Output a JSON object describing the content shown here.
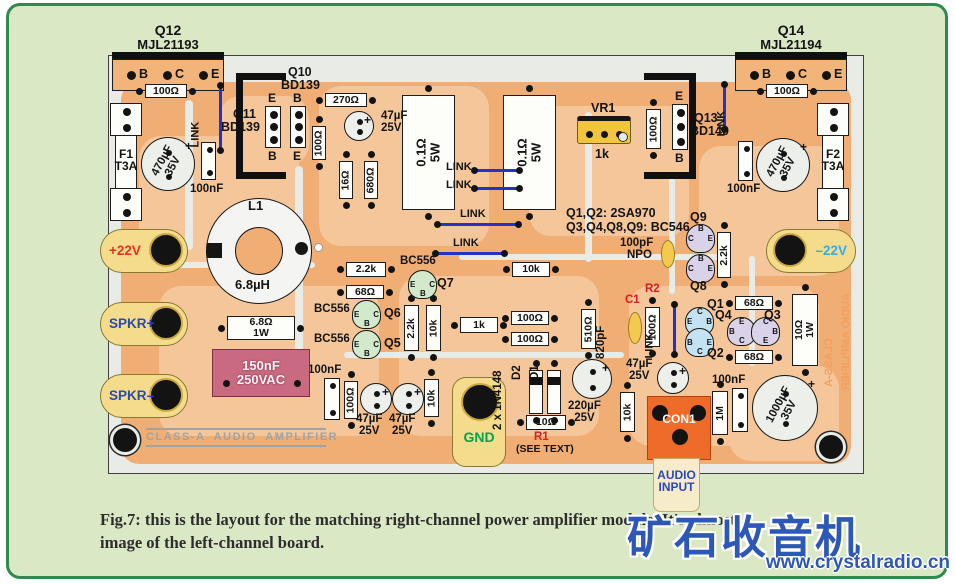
{
  "caption": {
    "line1": "Fig.7: this is the layout for the matching right-channel power amplifier module. It's almost",
    "line2": "image of the left-channel board."
  },
  "watermark": {
    "brand": "矿石收音机",
    "url": "www.crystalradio.cn"
  },
  "colors": {
    "panel_bg": "#dbe8c6",
    "panel_border": "#2e8a4d",
    "board_bg": "#e9ebe7",
    "copper": "#f0ad74",
    "copper_light": "#f5c69a",
    "terminal_yellow": "#f4dc8c",
    "connector_orange": "#ef6b2a",
    "film_pink": "#c96a80",
    "link_blue": "#2233c8",
    "red_label": "#d42020",
    "blue_label": "#2b48b8",
    "gnd_green": "#00a550",
    "neg22_blue": "#35aaee",
    "silk_gray": "#9fa4a2",
    "mirror_orange": "#f0a060"
  },
  "components": [
    {
      "id": "q12-header",
      "k": "header",
      "x": 112,
      "y": 52,
      "w": 112,
      "pins": [
        "B",
        "C",
        "E"
      ]
    },
    {
      "id": "q14-header",
      "k": "header",
      "x": 735,
      "y": 52,
      "w": 112,
      "pins": [
        "B",
        "C",
        "E"
      ]
    },
    {
      "id": "label-q12",
      "k": "text",
      "x": 123,
      "y": 23,
      "w": 90,
      "t": "Q12",
      "size": 14,
      "align": "center"
    },
    {
      "id": "label-q12-part",
      "k": "text",
      "x": 123,
      "y": 38,
      "w": 90,
      "t": "MJL21193",
      "size": 13,
      "align": "center"
    },
    {
      "id": "label-q14",
      "k": "text",
      "x": 746,
      "y": 23,
      "w": 90,
      "t": "Q14",
      "size": 14,
      "align": "center"
    },
    {
      "id": "label-q14-part",
      "k": "text",
      "x": 746,
      "y": 38,
      "w": 90,
      "t": "MJL21194",
      "size": 13,
      "align": "center"
    },
    {
      "id": "res-100r-topleft",
      "k": "resh",
      "x": 145,
      "y": 84,
      "w": 42,
      "h": 14,
      "t": "100Ω"
    },
    {
      "id": "res-270r",
      "k": "resh",
      "x": 325,
      "y": 93,
      "w": 42,
      "h": 14,
      "t": "270Ω"
    },
    {
      "id": "res-100r-topright",
      "k": "resh",
      "x": 766,
      "y": 84,
      "w": 42,
      "h": 14,
      "t": "100Ω"
    },
    {
      "id": "res-2k2-mid",
      "k": "resh",
      "x": 346,
      "y": 262,
      "w": 40,
      "h": 15,
      "t": "2.2k"
    },
    {
      "id": "res-68r-mid",
      "k": "resh",
      "x": 346,
      "y": 285,
      "w": 38,
      "h": 14,
      "t": "68Ω"
    },
    {
      "id": "res-10k-mid",
      "k": "resh",
      "x": 512,
      "y": 262,
      "w": 38,
      "h": 15,
      "t": "10k"
    },
    {
      "id": "res-1k",
      "k": "resh",
      "x": 460,
      "y": 317,
      "w": 38,
      "h": 16,
      "t": "1k"
    },
    {
      "id": "res-100r-a",
      "k": "resh",
      "x": 511,
      "y": 311,
      "w": 38,
      "h": 14,
      "t": "100Ω"
    },
    {
      "id": "res-100r-b",
      "k": "resh",
      "x": 511,
      "y": 332,
      "w": 38,
      "h": 14,
      "t": "100Ω"
    },
    {
      "id": "res-68r-q1",
      "k": "resh",
      "x": 735,
      "y": 296,
      "w": 38,
      "h": 14,
      "t": "68Ω"
    },
    {
      "id": "res-68r-q2",
      "k": "resh",
      "x": 735,
      "y": 350,
      "w": 38,
      "h": 14,
      "t": "68Ω"
    },
    {
      "id": "res-6r8-1w",
      "k": "resh",
      "x": 227,
      "y": 316,
      "w": 68,
      "h": 24,
      "t": "6.8Ω",
      "t2": "1W"
    },
    {
      "id": "res-10r-r1",
      "k": "resh",
      "x": 526,
      "y": 415,
      "w": 40,
      "h": 15,
      "t": "10Ω"
    },
    {
      "id": "res-100r-v1",
      "k": "resv",
      "x": 312,
      "y": 126,
      "w": 14,
      "h": 34,
      "t": "100Ω"
    },
    {
      "id": "res-16r",
      "k": "resv",
      "x": 339,
      "y": 161,
      "w": 14,
      "h": 38,
      "t": "16Ω"
    },
    {
      "id": "res-680r",
      "k": "resv",
      "x": 364,
      "y": 161,
      "w": 14,
      "h": 38,
      "t": "680Ω"
    },
    {
      "id": "res-100r-v2",
      "k": "resv",
      "x": 646,
      "y": 109,
      "w": 15,
      "h": 40,
      "t": "100Ω"
    },
    {
      "id": "res-2k2-v",
      "k": "resv",
      "x": 404,
      "y": 305,
      "w": 15,
      "h": 46,
      "t": "2.2k"
    },
    {
      "id": "res-10k-v1",
      "k": "resv",
      "x": 426,
      "y": 305,
      "w": 15,
      "h": 46,
      "t": "10k"
    },
    {
      "id": "res-510r",
      "k": "resv",
      "x": 581,
      "y": 309,
      "w": 15,
      "h": 40,
      "t": "510Ω"
    },
    {
      "id": "res-100r-v3",
      "k": "resv",
      "x": 645,
      "y": 307,
      "w": 15,
      "h": 40,
      "t": "100Ω"
    },
    {
      "id": "res-2k2-v2",
      "k": "resv",
      "x": 717,
      "y": 232,
      "w": 14,
      "h": 46,
      "t": "2.2k"
    },
    {
      "id": "res-10k-v2",
      "k": "resv",
      "x": 424,
      "y": 379,
      "w": 15,
      "h": 38,
      "t": "10k"
    },
    {
      "id": "res-100r-v4",
      "k": "resv",
      "x": 344,
      "y": 381,
      "w": 14,
      "h": 38,
      "t": "100Ω"
    },
    {
      "id": "res-10k-v3",
      "k": "resv",
      "x": 620,
      "y": 392,
      "w": 15,
      "h": 40,
      "t": "10k"
    },
    {
      "id": "res-1m",
      "k": "resv",
      "x": 712,
      "y": 391,
      "w": 16,
      "h": 44,
      "t": "1M"
    },
    {
      "id": "res-10r-1w",
      "k": "resv",
      "x": 792,
      "y": 294,
      "w": 26,
      "h": 72,
      "t": "10Ω",
      "t2": "1W"
    },
    {
      "id": "res-0r1-5w-a",
      "k": "resv",
      "x": 402,
      "y": 95,
      "w": 53,
      "h": 115,
      "t": "0.1Ω",
      "t2": "5W",
      "big": 1
    },
    {
      "id": "res-0r1-5w-b",
      "k": "resv",
      "x": 503,
      "y": 95,
      "w": 53,
      "h": 115,
      "t": "0.1Ω",
      "t2": "5W",
      "big": 1
    },
    {
      "id": "cap-100nf-1",
      "k": "nf",
      "x": 201,
      "y": 142,
      "w": 15,
      "h": 38
    },
    {
      "id": "cap-100nf-2",
      "k": "nf",
      "x": 738,
      "y": 141,
      "w": 15,
      "h": 40
    },
    {
      "id": "cap-100nf-3",
      "k": "nf",
      "x": 324,
      "y": 378,
      "w": 16,
      "h": 42
    },
    {
      "id": "cap-100nf-4",
      "k": "nf",
      "x": 732,
      "y": 388,
      "w": 16,
      "h": 44
    },
    {
      "id": "label-100nf-1",
      "k": "text",
      "x": 190,
      "y": 184,
      "t": "100nF"
    },
    {
      "id": "label-100nf-2",
      "k": "text",
      "x": 727,
      "y": 184,
      "t": "100nF"
    },
    {
      "id": "label-100nf-3",
      "k": "text",
      "x": 308,
      "y": 365,
      "t": "100nF"
    },
    {
      "id": "label-100nf-4",
      "k": "text",
      "x": 712,
      "y": 375,
      "t": "100nF"
    },
    {
      "id": "cap-150nf",
      "k": "film",
      "x": 212,
      "y": 349,
      "w": 98,
      "h": 48,
      "t": "150nF",
      "t2": "250VAC"
    },
    {
      "id": "cap-100pf",
      "k": "oval",
      "x": 661,
      "y": 240,
      "w": 14,
      "h": 28
    },
    {
      "id": "cap-820pf",
      "k": "oval",
      "x": 628,
      "y": 312,
      "w": 14,
      "h": 32
    },
    {
      "id": "label-100pf",
      "k": "text",
      "x": 620,
      "y": 238,
      "t": "100pF"
    },
    {
      "id": "label-npo",
      "k": "text",
      "x": 627,
      "y": 250,
      "t": "NPO"
    },
    {
      "id": "label-c1",
      "k": "text",
      "x": 625,
      "y": 295,
      "t": "C1",
      "color": "#d42020"
    },
    {
      "id": "label-r2",
      "k": "text",
      "x": 645,
      "y": 284,
      "t": "R2",
      "color": "#d42020"
    },
    {
      "id": "label-820pf",
      "k": "text",
      "x": 608,
      "y": 347,
      "t": "820pF",
      "rot": -90
    },
    {
      "id": "cap-470uf-left",
      "k": "capbig",
      "cx": 168,
      "cy": 164,
      "r": 27,
      "t": "470µF",
      "t2": "35V"
    },
    {
      "id": "cap-470uf-right",
      "k": "capbig",
      "cx": 783,
      "cy": 165,
      "r": 27,
      "t": "470µF",
      "t2": "35V"
    },
    {
      "id": "cap-1000uf",
      "k": "capbig",
      "cx": 785,
      "cy": 408,
      "r": 33,
      "t": "1000µF",
      "t2": "35V"
    },
    {
      "id": "cap-47uf-top",
      "k": "cap",
      "cx": 359,
      "cy": 126,
      "r": 15
    },
    {
      "id": "label-47uf-top",
      "k": "text",
      "x": 381,
      "y": 111,
      "t": "47µF",
      "t2": "25V",
      "align": "left"
    },
    {
      "id": "cap-47uf-a",
      "k": "cap",
      "cx": 376,
      "cy": 399,
      "r": 16
    },
    {
      "id": "cap-47uf-b",
      "k": "cap",
      "cx": 408,
      "cy": 399,
      "r": 16
    },
    {
      "id": "label-47uf-a",
      "k": "text",
      "x": 356,
      "y": 414,
      "t": "47µF",
      "t2": "25V"
    },
    {
      "id": "label-47uf-b",
      "k": "text",
      "x": 389,
      "y": 414,
      "t": "47µF",
      "t2": "25V"
    },
    {
      "id": "cap-220uf",
      "k": "cap",
      "cx": 592,
      "cy": 379,
      "r": 20
    },
    {
      "id": "label-220uf",
      "k": "text",
      "x": 568,
      "y": 401,
      "t": "220µF",
      "t2": "25V"
    },
    {
      "id": "cap-47uf-c",
      "k": "cap",
      "cx": 673,
      "cy": 378,
      "r": 16
    },
    {
      "id": "label-47uf-c",
      "k": "text",
      "x": 626,
      "y": 359,
      "t": "47µF",
      "t2": "25V"
    },
    {
      "id": "toroid-l1",
      "k": "toroid",
      "cx": 259,
      "cy": 251,
      "ro": 53,
      "ri": 24
    },
    {
      "id": "label-l1",
      "k": "text",
      "x": 248,
      "y": 199,
      "t": "L1",
      "size": 13
    },
    {
      "id": "label-l1-value",
      "k": "text",
      "x": 235,
      "y": 278,
      "t": "6.8µH",
      "size": 13
    },
    {
      "id": "trimpot-vr1",
      "k": "pot",
      "x": 577,
      "y": 116,
      "w": 54,
      "h": 28,
      "t": "VR1",
      "t2": "1k"
    },
    {
      "id": "fuse-f1",
      "k": "fuse",
      "x": 110,
      "y": 103,
      "w": 32,
      "h": 118,
      "t": "F1",
      "t2": "T3A"
    },
    {
      "id": "fuse-f2",
      "k": "fuse",
      "x": 817,
      "y": 103,
      "w": 32,
      "h": 118,
      "t": "F2",
      "t2": "T3A"
    },
    {
      "id": "terminal-plus22v",
      "k": "lug",
      "x": 100,
      "y": 229,
      "w": 88,
      "h": 44,
      "t": "+22V",
      "tc": "#e23222",
      "side": "r"
    },
    {
      "id": "terminal-spkr-plus",
      "k": "lug",
      "x": 100,
      "y": 302,
      "w": 88,
      "h": 44,
      "t": "SPKR+",
      "tc": "#2b48b8",
      "side": "r"
    },
    {
      "id": "terminal-spkr-minus",
      "k": "lug",
      "x": 100,
      "y": 374,
      "w": 88,
      "h": 44,
      "t": "SPKR–",
      "tc": "#2b48b8",
      "side": "r"
    },
    {
      "id": "terminal-minus22v",
      "k": "lug",
      "x": 766,
      "y": 229,
      "w": 90,
      "h": 44,
      "t": "–22V",
      "tc": "#35aaee",
      "side": "l"
    },
    {
      "id": "terminal-gnd",
      "k": "gnd",
      "x": 452,
      "y": 377,
      "w": 54,
      "h": 90,
      "t": "GND"
    },
    {
      "id": "connector-con1",
      "k": "con",
      "x": 647,
      "y": 396,
      "w": 64,
      "h": 64,
      "t": "CON1",
      "t2": "AUDIO",
      "t3": "INPUT"
    },
    {
      "id": "strip-q11",
      "k": "strip",
      "x": 265,
      "y": 106,
      "w": 16,
      "h": 42,
      "top": "E",
      "bot": "B"
    },
    {
      "id": "strip-q10",
      "k": "strip",
      "x": 290,
      "y": 106,
      "w": 16,
      "h": 42,
      "top": "B",
      "bot": "E"
    },
    {
      "id": "strip-q13",
      "k": "strip",
      "x": 672,
      "y": 104,
      "w": 16,
      "h": 46,
      "top": "E",
      "bot": "B"
    },
    {
      "id": "label-q10",
      "k": "text",
      "x": 288,
      "y": 66,
      "t": "Q10",
      "size": 12.5
    },
    {
      "id": "label-q10-part",
      "k": "text",
      "x": 281,
      "y": 79,
      "t": "BD139",
      "size": 12.5
    },
    {
      "id": "label-q11",
      "k": "text",
      "x": 233,
      "y": 108,
      "t": "Q11",
      "size": 12.5
    },
    {
      "id": "label-q11-part",
      "k": "text",
      "x": 221,
      "y": 121,
      "t": "BD139",
      "size": 12.5
    },
    {
      "id": "label-q13",
      "k": "text",
      "x": 694,
      "y": 112,
      "t": "Q13",
      "size": 12.5
    },
    {
      "id": "label-q13-part",
      "k": "text",
      "x": 690,
      "y": 125,
      "t": "BD140",
      "size": 12.5
    },
    {
      "id": "heatsink-bracket-left",
      "k": "bracket",
      "x": 236,
      "y": 73,
      "w": 50,
      "h": 106,
      "side": "l"
    },
    {
      "id": "heatsink-bracket-right",
      "k": "bracket",
      "x": 644,
      "y": 73,
      "w": 52,
      "h": 106,
      "side": "r"
    },
    {
      "id": "transistor-q7",
      "k": "tr",
      "x": 408,
      "y": 270,
      "c": "#d3e9cc",
      "pins": [
        [
          "E",
          "l"
        ],
        [
          "C",
          "r"
        ],
        [
          "B",
          "b"
        ]
      ]
    },
    {
      "id": "transistor-q6",
      "k": "tr",
      "x": 352,
      "y": 300,
      "c": "#d3e9cc",
      "pins": [
        [
          "E",
          "l"
        ],
        [
          "C",
          "r"
        ],
        [
          "B",
          "b"
        ]
      ]
    },
    {
      "id": "transistor-q5",
      "k": "tr",
      "x": 352,
      "y": 330,
      "c": "#d3e9cc",
      "pins": [
        [
          "E",
          "l"
        ],
        [
          "C",
          "r"
        ],
        [
          "B",
          "b"
        ]
      ]
    },
    {
      "id": "transistor-q9",
      "k": "tr",
      "x": 686,
      "y": 224,
      "c": "#d9d2e8",
      "pins": [
        [
          "C",
          "l"
        ],
        [
          "B",
          "t"
        ],
        [
          "E",
          "r"
        ]
      ]
    },
    {
      "id": "transistor-q8",
      "k": "tr",
      "x": 686,
      "y": 254,
      "c": "#d9d2e8",
      "pins": [
        [
          "C",
          "l"
        ],
        [
          "B",
          "t"
        ],
        [
          "E",
          "r"
        ]
      ]
    },
    {
      "id": "transistor-q1",
      "k": "tr",
      "x": 685,
      "y": 307,
      "c": "#c4e3f2",
      "pins": [
        [
          "E",
          "l"
        ],
        [
          "C",
          "t"
        ],
        [
          "B",
          "r"
        ]
      ]
    },
    {
      "id": "transistor-q2",
      "k": "tr",
      "x": 685,
      "y": 328,
      "c": "#c4e3f2",
      "pins": [
        [
          "B",
          "l"
        ],
        [
          "C",
          "b"
        ],
        [
          "E",
          "r"
        ]
      ]
    },
    {
      "id": "transistor-q4",
      "k": "tr",
      "x": 727,
      "y": 317,
      "c": "#d9d2e8",
      "pins": [
        [
          "E",
          "t"
        ],
        [
          "B",
          "l"
        ],
        [
          "C",
          "b"
        ]
      ]
    },
    {
      "id": "transistor-q3",
      "k": "tr",
      "x": 751,
      "y": 317,
      "c": "#d9d2e8",
      "pins": [
        [
          "C",
          "t"
        ],
        [
          "B",
          "r"
        ],
        [
          "E",
          "b"
        ]
      ]
    },
    {
      "id": "label-bc556-q7",
      "k": "text",
      "x": 400,
      "y": 256,
      "t": "BC556"
    },
    {
      "id": "label-q7",
      "k": "text",
      "x": 437,
      "y": 277,
      "t": "Q7",
      "size": 12.5
    },
    {
      "id": "label-bc556-q6",
      "k": "text",
      "x": 314,
      "y": 304,
      "t": "BC556"
    },
    {
      "id": "label-q6",
      "k": "text",
      "x": 384,
      "y": 307,
      "t": "Q6",
      "size": 12.5
    },
    {
      "id": "label-bc556-q5",
      "k": "text",
      "x": 314,
      "y": 334,
      "t": "BC556"
    },
    {
      "id": "label-q5",
      "k": "text",
      "x": 384,
      "y": 337,
      "t": "Q5",
      "size": 12.5
    },
    {
      "id": "label-q9",
      "k": "text",
      "x": 690,
      "y": 211,
      "t": "Q9",
      "size": 12.5
    },
    {
      "id": "label-q8",
      "k": "text",
      "x": 690,
      "y": 280,
      "t": "Q8",
      "size": 12.5
    },
    {
      "id": "label-q1",
      "k": "text",
      "x": 707,
      "y": 298,
      "t": "Q1",
      "size": 12.5
    },
    {
      "id": "label-q2",
      "k": "text",
      "x": 707,
      "y": 347,
      "t": "Q2",
      "size": 12.5
    },
    {
      "id": "label-q4",
      "k": "text",
      "x": 715,
      "y": 309,
      "t": "Q4",
      "size": 12.5
    },
    {
      "id": "label-q3",
      "k": "text",
      "x": 764,
      "y": 309,
      "t": "Q3",
      "size": 12.5
    },
    {
      "id": "note-line1",
      "k": "text",
      "x": 566,
      "y": 207,
      "t": "Q1,Q2: 2SA970",
      "size": 12.5
    },
    {
      "id": "note-line2",
      "k": "text",
      "x": 566,
      "y": 221,
      "t": "Q3,Q4,Q8,Q9: BC546",
      "size": 12.5
    },
    {
      "id": "diode-d2",
      "k": "diode",
      "x": 529,
      "y": 370,
      "w": 14,
      "h": 44
    },
    {
      "id": "diode-d1",
      "k": "diode",
      "x": 547,
      "y": 370,
      "w": 14,
      "h": 44
    },
    {
      "id": "label-diodes",
      "k": "text",
      "x": 505,
      "y": 418,
      "t": "2 x 1N4148",
      "rot": -90
    },
    {
      "id": "label-d2",
      "k": "text",
      "x": 524,
      "y": 368,
      "t": "D2",
      "rot": -90
    },
    {
      "id": "label-d1",
      "k": "text",
      "x": 542,
      "y": 368,
      "t": "D1",
      "rot": -90
    },
    {
      "id": "label-r1",
      "k": "text",
      "x": 534,
      "y": 432,
      "t": "R1",
      "color": "#d42020"
    },
    {
      "id": "label-see-text",
      "k": "text",
      "x": 516,
      "y": 444,
      "t": "(SEE TEXT)",
      "size": 10.5
    },
    {
      "id": "link-v1",
      "k": "linkv",
      "x": 219,
      "y": 88,
      "len": 60,
      "t": "LINK",
      "lx": 202,
      "ly": 136
    },
    {
      "id": "link-v2",
      "k": "linkv",
      "x": 723,
      "y": 87,
      "len": 40,
      "t": "LINK",
      "lx": 728,
      "ly": 125
    },
    {
      "id": "link-v3",
      "k": "linkv",
      "x": 673,
      "y": 307,
      "len": 45,
      "t": "LINK",
      "lx": 656,
      "ly": 347
    },
    {
      "id": "link-h1",
      "k": "linkh",
      "x": 477,
      "y": 169,
      "len": 40,
      "t": "LINK",
      "lx": 446,
      "ly": 162
    },
    {
      "id": "link-h2",
      "k": "linkh",
      "x": 477,
      "y": 187,
      "len": 40,
      "t": "LINK",
      "lx": 446,
      "ly": 180
    },
    {
      "id": "link-h3",
      "k": "linkh",
      "x": 440,
      "y": 223,
      "len": 76,
      "t": "LINK",
      "lx": 460,
      "ly": 209
    },
    {
      "id": "link-h4",
      "k": "linkh",
      "x": 438,
      "y": 252,
      "len": 64,
      "t": "LINK",
      "lx": 453,
      "ly": 238
    },
    {
      "id": "mounting-hole-left",
      "k": "hole",
      "cx": 125,
      "cy": 440,
      "r": 12
    },
    {
      "id": "mounting-hole-right",
      "k": "hole",
      "cx": 831,
      "cy": 447,
      "r": 12
    },
    {
      "id": "silkscreen-title",
      "k": "silk",
      "x": 146,
      "y": 428,
      "w": 180,
      "t": "CLASS-A  AUDIO  AMPLIFIER"
    },
    {
      "id": "mirror-text-1",
      "k": "vtext",
      "x": 841,
      "y": 282,
      "h": 120,
      "t": "AUDIO AMPLIFIER"
    },
    {
      "id": "mirror-text-2",
      "k": "vtext",
      "x": 824,
      "y": 316,
      "h": 92,
      "t": "CLASS-A"
    }
  ]
}
